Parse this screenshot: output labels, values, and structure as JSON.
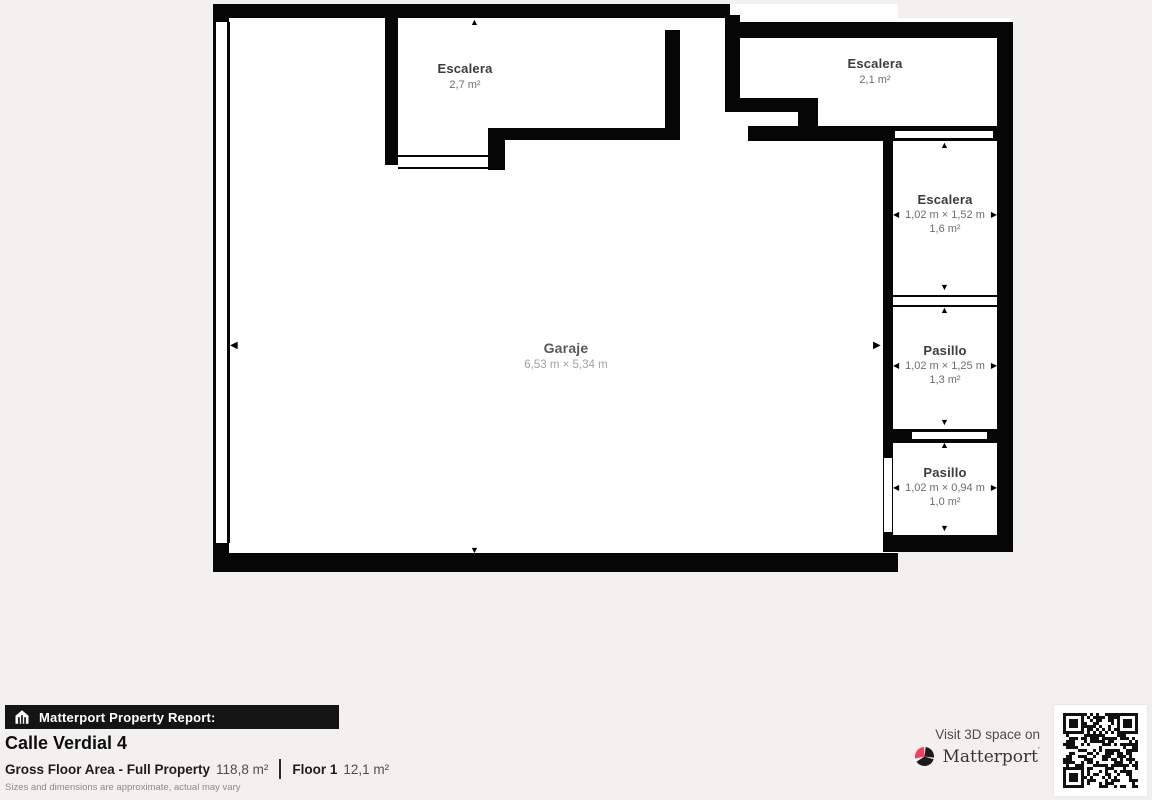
{
  "plan": {
    "rooms": {
      "escalera_top_left": {
        "name": "Escalera",
        "area": "2,7 m²"
      },
      "escalera_top_right": {
        "name": "Escalera",
        "area": "2,1 m²"
      },
      "escalera_right": {
        "name": "Escalera",
        "dimensions": "1,02 m × 1,52 m",
        "area": "1,6 m²"
      },
      "pasillo_middle": {
        "name": "Pasillo",
        "dimensions": "1,02 m × 1,25 m",
        "area": "1,3 m²"
      },
      "pasillo_bottom": {
        "name": "Pasillo",
        "dimensions": "1,02 m × 0,94 m",
        "area": "1,0 m²"
      },
      "garaje": {
        "name": "Garaje",
        "dimensions": "6,53 m × 5,34 m"
      }
    },
    "icons": {
      "arrow_up": "▲",
      "arrow_down": "▼",
      "arrow_left": "◀",
      "arrow_right": "▶"
    }
  },
  "footer": {
    "report_label": "Matterport Property Report:",
    "property_name": "Calle Verdial 4",
    "gross_floor_label": "Gross Floor Area - Full Property",
    "gross_floor_value": "118,8 m²",
    "floor_label": "Floor 1",
    "floor_value": "12,1 m²",
    "disclaimer": "Sizes and dimensions are approximate, actual may vary",
    "visit_text": "Visit 3D space on",
    "brand": "Matterport",
    "brand_mark": "′"
  },
  "colors": {
    "wall": "#060606",
    "background": "#f3f1ef",
    "accent_pink": "#f0425f",
    "room_name": "#3c3c3c",
    "room_sub": "#6d6d6d"
  }
}
